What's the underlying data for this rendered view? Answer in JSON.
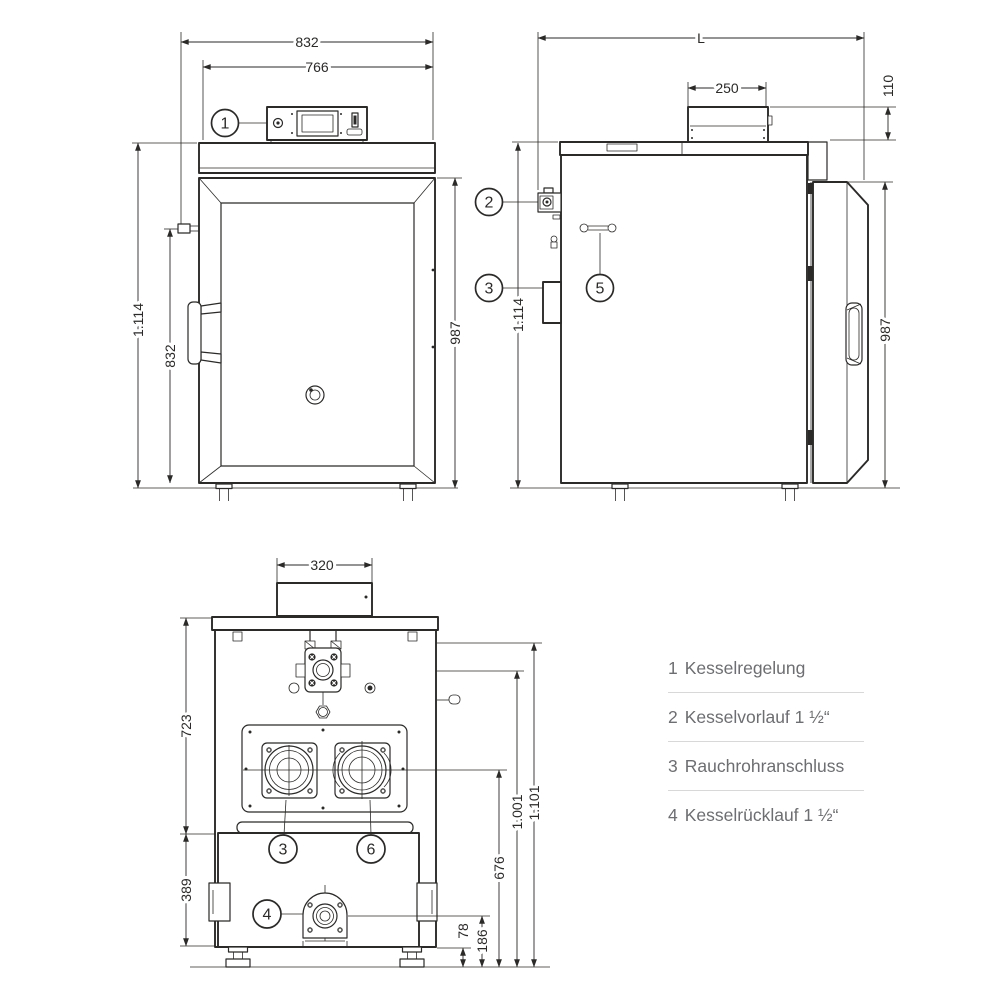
{
  "drawing": {
    "front": {
      "width_outer": "832",
      "width_inner": "766",
      "height_total": "1.114",
      "height_door": "832",
      "height_body": "987",
      "callout_control": "1"
    },
    "side": {
      "length": "L",
      "panel_width": "250",
      "panel_height": "110",
      "height_total": "1.114",
      "height_door": "987",
      "callout_flow": "2",
      "callout_flue": "3",
      "callout_lever": "5"
    },
    "rear": {
      "flue_width": "320",
      "upper_height": "723",
      "lower_height": "389",
      "foot_height": "78",
      "return_height": "186",
      "port_height": "676",
      "valve_height": "1.001",
      "total_height": "1.101",
      "callout_flue": "3",
      "callout_sensor": "6",
      "callout_return": "4"
    },
    "legend": {
      "items": [
        {
          "number": "1",
          "label": "Kesselregelung"
        },
        {
          "number": "2",
          "label": "Kesselvorlauf 1 ½“"
        },
        {
          "number": "3",
          "label": "Rauchrohranschluss"
        },
        {
          "number": "4",
          "label": "Kesselrücklauf 1 ½“"
        }
      ]
    }
  },
  "colors": {
    "line": "#2b2a29",
    "legend_text": "#6d6e71",
    "divider": "#d8d8d8",
    "background": "#ffffff"
  }
}
